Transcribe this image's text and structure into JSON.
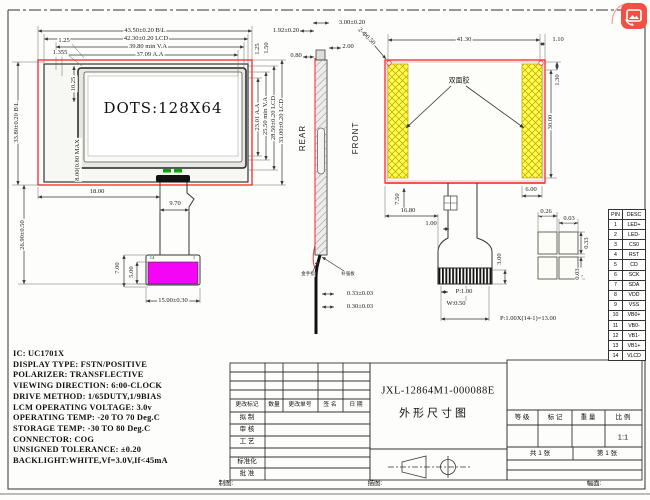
{
  "front_view": {
    "display_text": "DOTS:128X64",
    "connector_pin_left": "14",
    "connector_pin_right": "1",
    "dims": {
      "width_bl": "43.50±0.20 B\\L",
      "width_lcd": "42.30±0.20 LCD",
      "width_va": "39.80 min V.A",
      "width_aa": "37.09 A.A",
      "off_125": "1.25",
      "off_1355": "1.355",
      "off_1025": "10.25",
      "max_080": "8.00(0.80 MAX",
      "height_bl": "33.80±0.20 B\\L",
      "tail_2690": "26.90±0.50",
      "r_aa": "23.01 A.A",
      "r_va": "25.50 min V.A",
      "r_lcd": "28.50±0.20 LCD",
      "r_bl": "33.00±0.20 LCD",
      "r_125": "1.25",
      "r_150": "1.50",
      "b_1800": "18.00",
      "b_970": "9.70",
      "b_700": "7.00",
      "b_500": "5.00",
      "b_1500": "15.00±0.30"
    }
  },
  "side_view": {
    "rear_label": "REAR",
    "front_label": "FRONT",
    "gold_finger": "金手指",
    "stiffener": "补强板",
    "dims": {
      "t_192": "1.92±0.20",
      "t_300": "3.00±0.20",
      "t_200": "2.00",
      "t_080": "0.80",
      "holes": "2-Φ0.50",
      "b_033": "0.33±0.03",
      "b_030": "0.30±0.03"
    }
  },
  "rear_view": {
    "tape_label": "双面胶",
    "dims": {
      "w_4130": "41.30",
      "r_110": "1.10",
      "r_130": "1.30",
      "r_3000": "30.00",
      "b_600": "6.00",
      "l_750": "7.50",
      "l_1680": "16.80",
      "l_100": "1.00",
      "c_300": "3.00",
      "pin_pitch": "P:1.00",
      "pin_width": "W:0.50",
      "pitch_total": "P:1.00X(14-1)=13.00"
    }
  },
  "detail_view": {
    "dims": {
      "d_026": "0.26",
      "d_003a": "0.03",
      "d_033": "0.33",
      "d_003b": "0.03"
    }
  },
  "pin_table": {
    "headers": [
      "PIN",
      "DESC"
    ],
    "rows": [
      [
        "1",
        "LED+"
      ],
      [
        "2",
        "LED-"
      ],
      [
        "3",
        "CS0"
      ],
      [
        "4",
        "RST"
      ],
      [
        "5",
        "CD"
      ],
      [
        "6",
        "SCK"
      ],
      [
        "7",
        "SDA"
      ],
      [
        "8",
        "VDD"
      ],
      [
        "9",
        "VSS"
      ],
      [
        "10",
        "VB0+"
      ],
      [
        "11",
        "VB0-"
      ],
      [
        "12",
        "VB1-"
      ],
      [
        "13",
        "VB1+"
      ],
      [
        "14",
        "VLCD"
      ]
    ]
  },
  "specs": {
    "lines": [
      "IC: UC1701X",
      "DISPLAY TYPE: FSTN/POSITIVE",
      "POLARIZER: TRANSFLECTIVE",
      "VIEWING DIRECTION: 6:00-CLOCK",
      "DRIVE METHOD: 1/65DUTY,1/9BIAS",
      "LCM OPERATING VOLTAGE: 3.0v",
      "OPERATING TEMP: -20 TO 70 Deg.C",
      "STORAGE TEMP: -30 TO 80 Deg.C",
      "CONNECTOR: COG",
      "UNSIGNED TOLERANCE: ±0.20",
      "BACKLIGHT:WHITE,Vf=3.0V,If<45mA"
    ]
  },
  "title_block": {
    "part_no": "JXL-12864M1-000088E",
    "drawing_title": "外形尺寸图",
    "rev_mark": "更改标记",
    "rev_qty": "数量",
    "rev_order": "更改单号",
    "rev_sign": "签 名",
    "rev_date": "日 期",
    "role_draft": "拟 制",
    "role_check": "审 核",
    "role_process": "工 艺",
    "role_standard": "标准化",
    "role_approve": "批 准",
    "grade": "等 级",
    "mark": "标 记",
    "weight": "重 量",
    "scale": "比 例",
    "scale_val": "1:1",
    "total_sheets": "共 1 张",
    "sheet_no": "第 1 张",
    "bottom_draw": "制图:",
    "bottom_trace": "描图:",
    "bottom_format": "幅面:"
  },
  "colors": {
    "accent_red": "#ff2a2a",
    "magenta": "#ff00ff",
    "tape_yellow": "#ffff55",
    "strip_green": "#00aa00",
    "icon_red": "#f15045"
  }
}
